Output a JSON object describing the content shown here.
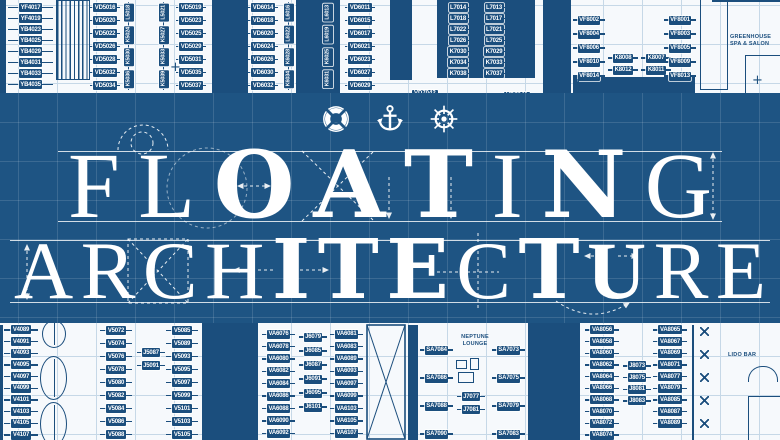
{
  "title": {
    "line1": "FLOATING",
    "line1_styles": [
      "lt",
      "lt",
      "hv",
      "hv",
      "hv",
      "lt",
      "hv",
      "lt"
    ],
    "line2": "ARCHITECTURE",
    "line2_styles": [
      "lt",
      "lt",
      "lt",
      "lt",
      "hv",
      "hv",
      "hv",
      "lt",
      "hv",
      "md",
      "lt",
      "lt"
    ]
  },
  "icons": [
    {
      "name": "lifebuoy-icon"
    },
    {
      "name": "anchor-icon"
    },
    {
      "name": "ship-wheel-icon"
    }
  ],
  "colors": {
    "band_blue": "#1e5483",
    "plan_ink": "#1b4e7d",
    "paper": "#f6f9fc",
    "grid_line": "#c6d8e7",
    "title_white": "#ffffff"
  },
  "marks": {
    "plus": "+"
  },
  "deck_plan": {
    "rooms": {
      "greenhouse": "GREENHOUSE\nSPA & SALON",
      "neptune": "NEPTUNE\nLOUNGE",
      "lido": "LIDO BAR"
    },
    "singles": {
      "vd7042": "VD7042",
      "vd7041": "VD7041"
    },
    "columns": {
      "tL": [
        "YF4017",
        "YF4019",
        "YB4023",
        "YB4025",
        "YB4029",
        "YB4031",
        "YB4033",
        "YB4035"
      ],
      "t50L": [
        "VD5016",
        "VD5020",
        "VD5022",
        "VD5026",
        "VD5028",
        "VD5032",
        "VD5034"
      ],
      "t50v1": [
        "L5018",
        "K5024",
        "K5030",
        "K5036"
      ],
      "t50v2": [
        "L5021",
        "K5027",
        "K5033",
        "K5039"
      ],
      "t50R": [
        "VD5019",
        "VD5023",
        "VD5025",
        "VD5029",
        "VD5031",
        "VD5035",
        "VD5037"
      ],
      "t60L": [
        "VD6014",
        "VD6018",
        "VD6020",
        "VD6024",
        "VD6026",
        "VD6030",
        "VD6032"
      ],
      "t60v1": [
        "L6016",
        "L6022",
        "K6028",
        "K6034"
      ],
      "t60v2": [
        "L6013",
        "L6019",
        "K6025",
        "K6031"
      ],
      "t60R": [
        "VD6011",
        "VD6015",
        "VD6017",
        "VD6021",
        "VD6023",
        "VD6027",
        "VD6029"
      ],
      "t70L": [
        "L7014",
        "L7018",
        "L7022",
        "L7026",
        "K7030",
        "K7034",
        "K7038"
      ],
      "t70R": [
        "L7013",
        "L7017",
        "L7021",
        "L7025",
        "K7029",
        "K7033",
        "K7037"
      ],
      "t80L": [
        "VF8002",
        "VF8004",
        "VF8006",
        "VF8010",
        "VF8014"
      ],
      "t80k1": [
        "K8008",
        "K8012"
      ],
      "t80k2": [
        "K8007",
        "K8011"
      ],
      "t80R": [
        "VF8001",
        "VF8003",
        "VF8005",
        "VF8009",
        "VF8013"
      ],
      "bV40": [
        "V4089",
        "V4091",
        "V4093",
        "V4095",
        "V4097",
        "V4099",
        "V4101",
        "V4103",
        "V4105",
        "V4107"
      ],
      "bV50L": [
        "V5072",
        "V5074",
        "V5076",
        "V5078",
        "V5080",
        "V5082",
        "V5084",
        "V5086",
        "V5088"
      ],
      "bJ50": [
        "J5087",
        "J5091"
      ],
      "bV50R": [
        "V5085",
        "V5089",
        "V5093",
        "V5095",
        "V5097",
        "V5099",
        "V5101",
        "V5103",
        "V5105"
      ],
      "bVA60L": [
        "VA6076",
        "VA6078",
        "VA6080",
        "VA6082",
        "VA6084",
        "VA6086",
        "VA6088",
        "VA6090",
        "VA6092"
      ],
      "bJ60": [
        "J6079",
        "J6085",
        "J6087",
        "J6091",
        "J6095",
        "J6101"
      ],
      "bVA60R": [
        "VA6081",
        "VA6083",
        "VA6089",
        "VA6093",
        "VA6097",
        "VA6099",
        "VA6103",
        "VA6105",
        "VA6107"
      ],
      "bSA70L": [
        "SA7084",
        "SA7086",
        "SA7088",
        "SA7090"
      ],
      "bJ70": [
        "J7077",
        "J7081"
      ],
      "bSA70R": [
        "SA7073",
        "SA7075",
        "SA7079",
        "SA7083"
      ],
      "bVA80L": [
        "VA8056",
        "VA8058",
        "VA8060",
        "VA8062",
        "VA8064",
        "VA8066",
        "VA8068",
        "VA8070",
        "VA8072",
        "VA8074"
      ],
      "bJ80": [
        "J8073",
        "J8075",
        "J8081",
        "J8083"
      ],
      "bVA80R": [
        "VA8065",
        "VA8067",
        "VA8069",
        "VA8071",
        "VA8077",
        "VA8079",
        "VA8085",
        "VA8087",
        "VA8089"
      ]
    }
  }
}
